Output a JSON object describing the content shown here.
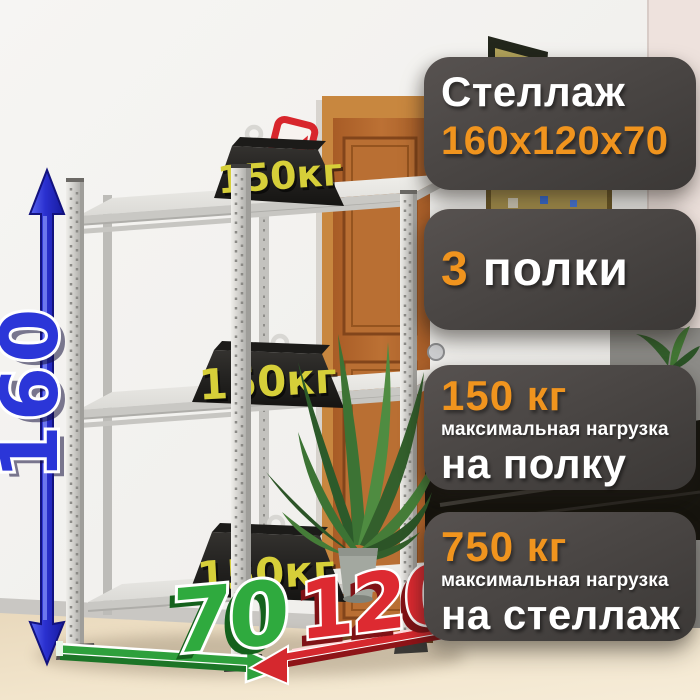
{
  "card": {
    "badges": [
      {
        "title": "Стеллаж",
        "size": "160х120х70"
      },
      {
        "count": "3",
        "label": "полки"
      },
      {
        "value": "150 кг",
        "note": "максимальная нагрузка",
        "target": "на полку"
      },
      {
        "value": "750 кг",
        "note": "максимальная нагрузка",
        "target": "на стеллаж"
      }
    ]
  },
  "dimensions": {
    "height": "160",
    "depth": "70",
    "width": "120"
  },
  "weights": {
    "label": "150кг"
  },
  "colors": {
    "accent_orange": "#F0941E",
    "badge_background": "#4A4643",
    "height_arrow": "#2B36D8",
    "depth_arrow": "#2FA23C",
    "width_arrow": "#D5282E",
    "weight_label": "#D6CF39",
    "brand_logo": "#D8262C"
  },
  "icons": [
    "height-arrow-icon",
    "depth-arrow-icon",
    "width-arrow-icon",
    "weight-eye-icon",
    "brand-logo-icon"
  ]
}
